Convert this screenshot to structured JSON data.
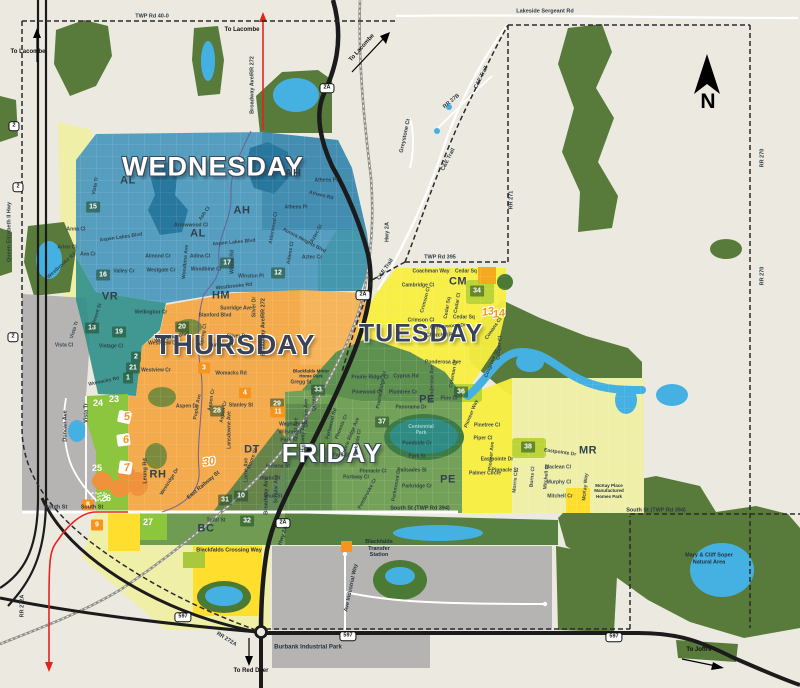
{
  "compass": {
    "label": "N"
  },
  "colors": {
    "background": "#ECEAE0",
    "forest": "#587B3B",
    "water": "#45B1E3",
    "wednesday": "#4A98BC",
    "thursday": "#F4A844",
    "tuesday": "#F8EE3F",
    "friday": "#74A159",
    "accent_orange": "#F7941E",
    "urban_gray": "#B5B4B2",
    "residential_green": "#8CC63F",
    "pale_yellow": "#EFEFA8",
    "route_red": "#E8211D"
  },
  "day_labels": [
    {
      "t": "WEDNESDAY",
      "x": 213,
      "y": 167,
      "v": "light",
      "s": 27
    },
    {
      "t": "THURSDAY",
      "x": 235,
      "y": 345,
      "v": "dark",
      "s": 28
    },
    {
      "t": "TUESDAY",
      "x": 421,
      "y": 334,
      "v": "dark",
      "s": 25
    },
    {
      "t": "FRIDAY",
      "x": 332,
      "y": 453,
      "v": "light",
      "s": 26
    }
  ],
  "area_codes": [
    {
      "t": "AL",
      "x": 128,
      "y": 181
    },
    {
      "t": "AL",
      "x": 198,
      "y": 234
    },
    {
      "t": "AH",
      "x": 293,
      "y": 174
    },
    {
      "t": "AH",
      "x": 242,
      "y": 211
    },
    {
      "t": "VR",
      "x": 110,
      "y": 297
    },
    {
      "t": "HM",
      "x": 221,
      "y": 296
    },
    {
      "t": "RH",
      "x": 158,
      "y": 475
    },
    {
      "t": "DT",
      "x": 252,
      "y": 450
    },
    {
      "t": "CM",
      "x": 458,
      "y": 282
    },
    {
      "t": "PE",
      "x": 427,
      "y": 400
    },
    {
      "t": "PE",
      "x": 448,
      "y": 480
    },
    {
      "t": "MR",
      "x": 588,
      "y": 451
    },
    {
      "t": "BC",
      "x": 206,
      "y": 529
    }
  ],
  "badges": {
    "green": [
      {
        "n": "15",
        "x": 93,
        "y": 207
      },
      {
        "n": "16",
        "x": 103,
        "y": 275
      },
      {
        "n": "17",
        "x": 227,
        "y": 263
      },
      {
        "n": "12",
        "x": 278,
        "y": 273
      },
      {
        "n": "18",
        "x": 92,
        "y": 328
      },
      {
        "n": "19",
        "x": 119,
        "y": 332
      },
      {
        "n": "20",
        "x": 182,
        "y": 327
      },
      {
        "n": "2",
        "x": 136,
        "y": 357
      },
      {
        "n": "21",
        "x": 133,
        "y": 368
      },
      {
        "n": "1",
        "x": 128,
        "y": 378
      },
      {
        "n": "28",
        "x": 217,
        "y": 411
      },
      {
        "n": "29",
        "x": 277,
        "y": 404
      },
      {
        "n": "33",
        "x": 318,
        "y": 390
      },
      {
        "n": "31",
        "x": 225,
        "y": 500
      },
      {
        "n": "10",
        "x": 241,
        "y": 496
      },
      {
        "n": "32",
        "x": 247,
        "y": 521
      },
      {
        "n": "34",
        "x": 477,
        "y": 291
      },
      {
        "n": "36",
        "x": 461,
        "y": 392
      },
      {
        "n": "37",
        "x": 382,
        "y": 422
      },
      {
        "n": "38",
        "x": 528,
        "y": 447
      }
    ],
    "orange": [
      {
        "n": "3",
        "x": 204,
        "y": 368
      },
      {
        "n": "4",
        "x": 245,
        "y": 393
      },
      {
        "n": "11",
        "x": 278,
        "y": 412
      },
      {
        "n": "8",
        "x": 88,
        "y": 505
      },
      {
        "n": "9",
        "x": 97,
        "y": 525
      }
    ],
    "plain": [
      {
        "n": "24",
        "x": 98,
        "y": 403
      },
      {
        "n": "23",
        "x": 114,
        "y": 399
      },
      {
        "n": "25",
        "x": 97,
        "y": 468
      },
      {
        "n": "26",
        "x": 106,
        "y": 498
      },
      {
        "n": "27",
        "x": 148,
        "y": 522
      }
    ],
    "stylized": [
      {
        "n": "5",
        "x": 127,
        "y": 417
      },
      {
        "n": "6",
        "x": 126,
        "y": 440
      },
      {
        "n": "7",
        "x": 127,
        "y": 468
      },
      {
        "n": "13",
        "x": 488,
        "y": 312
      },
      {
        "n": "14",
        "x": 499,
        "y": 314
      },
      {
        "n": "30",
        "x": 209,
        "y": 462
      }
    ]
  },
  "shields": [
    {
      "t": "2",
      "x": 14,
      "y": 126
    },
    {
      "t": "2",
      "x": 18,
      "y": 187
    },
    {
      "t": "2",
      "x": 13,
      "y": 337
    },
    {
      "t": "2A",
      "x": 327,
      "y": 88
    },
    {
      "t": "2A",
      "x": 363,
      "y": 295
    },
    {
      "t": "2A",
      "x": 283,
      "y": 523
    },
    {
      "t": "597",
      "x": 183,
      "y": 617
    },
    {
      "t": "597",
      "x": 348,
      "y": 636
    },
    {
      "t": "597",
      "x": 614,
      "y": 637
    }
  ],
  "road_labels": [
    {
      "t": "TWP Rd 40-0",
      "x": 152,
      "y": 17
    },
    {
      "t": "Lakeside Sergeant Rd",
      "x": 545,
      "y": 12
    },
    {
      "t": "TWP Rd 395",
      "x": 440,
      "y": 258
    },
    {
      "t": "South St",
      "x": 56,
      "y": 508
    },
    {
      "t": "South St",
      "x": 92,
      "y": 508
    },
    {
      "t": "South St (TWP Rd 394)",
      "x": 420,
      "y": 509
    },
    {
      "t": "South St (TWP Rd 394)",
      "x": 656,
      "y": 511
    },
    {
      "t": "RR 270",
      "x": 763,
      "y": 158,
      "r": -90
    },
    {
      "t": "RR 270",
      "x": 763,
      "y": 276,
      "r": -90
    },
    {
      "t": "RR 271",
      "x": 512,
      "y": 200,
      "r": -90
    },
    {
      "t": "C&E Trail",
      "x": 482,
      "y": 78,
      "r": -63
    },
    {
      "t": "C&E Trail",
      "x": 449,
      "y": 160,
      "r": -63
    },
    {
      "t": "C&E Trail",
      "x": 386,
      "y": 270,
      "r": -56
    },
    {
      "t": "RR 27B",
      "x": 452,
      "y": 102,
      "r": -40
    },
    {
      "t": "Greystone Ct",
      "x": 406,
      "y": 136,
      "r": -78
    },
    {
      "t": "Queen Elizabeth II Hwy",
      "x": 10,
      "y": 232,
      "r": -90
    },
    {
      "t": "Broadway Ave/RR 272",
      "x": 253,
      "y": 85,
      "r": -90
    },
    {
      "t": "Broadway Ave/RR 272",
      "x": 264,
      "y": 327,
      "r": -90
    },
    {
      "t": "Broadway Ave",
      "x": 267,
      "y": 496,
      "r": -90
    },
    {
      "t": "Hwy 2A",
      "x": 388,
      "y": 232,
      "r": -90
    },
    {
      "t": "Hwy 2A",
      "x": 284,
      "y": 536,
      "r": -72
    },
    {
      "t": "RR 272A",
      "x": 23,
      "y": 606,
      "r": -90
    },
    {
      "t": "RR 272A",
      "x": 226,
      "y": 640,
      "r": 32
    },
    {
      "t": "Duncan Ave",
      "x": 66,
      "y": 426,
      "r": -90
    },
    {
      "t": "Vista Tr",
      "x": 87,
      "y": 413,
      "r": -90
    },
    {
      "t": "East Railway St",
      "x": 204,
      "y": 486,
      "r": -40
    },
    {
      "t": "Leung Rd",
      "x": 146,
      "y": 471,
      "r": -90
    },
    {
      "t": "Ave Industrial Way",
      "x": 352,
      "y": 588,
      "r": -78
    }
  ],
  "direction_labels": [
    {
      "t": "To Lacombe",
      "x": 28,
      "y": 52
    },
    {
      "t": "To Lacombe",
      "x": 242,
      "y": 30
    },
    {
      "t": "To Lacombe",
      "x": 362,
      "y": 48,
      "r": -48
    },
    {
      "t": "To Red Deer",
      "x": 251,
      "y": 671
    },
    {
      "t": "To Joffre",
      "x": 699,
      "y": 650
    }
  ],
  "place_labels": [
    {
      "t": "Burbank Industrial Park",
      "x": 308,
      "y": 648,
      "s": 6
    },
    {
      "t": "Blackfalds\nTransfer\nStation",
      "x": 379,
      "y": 549,
      "s": 5.5
    },
    {
      "t": "Blackfalds Crossing Way",
      "x": 229,
      "y": 551,
      "s": 5.5
    },
    {
      "t": "Mary & Cliff Soper\nNatural Area",
      "x": 709,
      "y": 559,
      "s": 5.5
    },
    {
      "t": "Centennial\nPark",
      "x": 421,
      "y": 430,
      "s": 5,
      "c": "#9AD3CC"
    },
    {
      "t": "Blackfalds Motor\nHome Park",
      "x": 311,
      "y": 374,
      "s": 4.5
    },
    {
      "t": "McKay Place\nManufactured\nHomes Park",
      "x": 609,
      "y": 491,
      "s": 4.5
    }
  ],
  "street_labels": [
    {
      "t": "Vista Tr",
      "x": 96,
      "y": 186,
      "r": -80
    },
    {
      "t": "Anna Cl",
      "x": 76,
      "y": 230
    },
    {
      "t": "Aspen Lakes Blvd",
      "x": 121,
      "y": 238,
      "r": -8
    },
    {
      "t": "Arlen Cl",
      "x": 67,
      "y": 248
    },
    {
      "t": "Ava Cr",
      "x": 88,
      "y": 255
    },
    {
      "t": "Valley Cr",
      "x": 124,
      "y": 272
    },
    {
      "t": "Westgate Cr",
      "x": 161,
      "y": 271
    },
    {
      "t": "Almond Cr",
      "x": 158,
      "y": 257
    },
    {
      "t": "Adina Cl",
      "x": 200,
      "y": 257
    },
    {
      "t": "Arrowwood Cl",
      "x": 191,
      "y": 226
    },
    {
      "t": "Ash Cl",
      "x": 205,
      "y": 214,
      "r": -55
    },
    {
      "t": "Aspen Lakes Blvd",
      "x": 234,
      "y": 243,
      "r": -5
    },
    {
      "t": "Woodbine Cl",
      "x": 206,
      "y": 270
    },
    {
      "t": "Woodbine Ave",
      "x": 186,
      "y": 262,
      "r": -85
    },
    {
      "t": "Willow Rd",
      "x": 233,
      "y": 262,
      "r": -90
    },
    {
      "t": "Winston Pl",
      "x": 251,
      "y": 277
    },
    {
      "t": "Westbrooke Rd",
      "x": 234,
      "y": 287,
      "r": -6
    },
    {
      "t": "Westbrooke Rd",
      "x": 62,
      "y": 266,
      "r": -42
    },
    {
      "t": "Athens Pl",
      "x": 326,
      "y": 181
    },
    {
      "t": "Athens Rd",
      "x": 321,
      "y": 196,
      "r": 14
    },
    {
      "t": "Athens Pl",
      "x": 296,
      "y": 208
    },
    {
      "t": "Alderwood Cl",
      "x": 274,
      "y": 228,
      "r": -80
    },
    {
      "t": "Aurora Heights Blvd",
      "x": 304,
      "y": 241,
      "r": 28
    },
    {
      "t": "Aztec St",
      "x": 317,
      "y": 234,
      "r": -62
    },
    {
      "t": "Aztec Cr",
      "x": 312,
      "y": 258
    },
    {
      "t": "Adams Cl",
      "x": 291,
      "y": 253,
      "r": -80
    },
    {
      "t": "Valmont St",
      "x": 97,
      "y": 316,
      "r": -72
    },
    {
      "t": "Vista Tr",
      "x": 75,
      "y": 330,
      "r": -72
    },
    {
      "t": "Vista Cl",
      "x": 64,
      "y": 346
    },
    {
      "t": "Vintage Cl",
      "x": 111,
      "y": 347
    },
    {
      "t": "Womacks Rd",
      "x": 104,
      "y": 382,
      "r": -12
    },
    {
      "t": "Wellington Cr",
      "x": 151,
      "y": 313
    },
    {
      "t": "Sunridge Ave",
      "x": 236,
      "y": 309
    },
    {
      "t": "Stanford Blvd",
      "x": 215,
      "y": 316
    },
    {
      "t": "Silver Dr",
      "x": 237,
      "y": 337
    },
    {
      "t": "Silver Dr",
      "x": 255,
      "y": 307,
      "r": -90
    },
    {
      "t": "Sunrise Cl",
      "x": 221,
      "y": 346
    },
    {
      "t": "Womacks Blvd",
      "x": 172,
      "y": 338,
      "r": -12
    },
    {
      "t": "Westview Cr",
      "x": 163,
      "y": 344
    },
    {
      "t": "Westview Cr",
      "x": 156,
      "y": 371
    },
    {
      "t": "Spring Cl",
      "x": 204,
      "y": 335,
      "r": -80
    },
    {
      "t": "Womacks Rd",
      "x": 231,
      "y": 374
    },
    {
      "t": "Gregg St",
      "x": 301,
      "y": 383
    },
    {
      "t": "Aspen Dr",
      "x": 187,
      "y": 407
    },
    {
      "t": "Poplar Ave",
      "x": 198,
      "y": 407,
      "r": -80
    },
    {
      "t": "Aspen Cr",
      "x": 212,
      "y": 400,
      "r": -80
    },
    {
      "t": "Aspen Cr",
      "x": 224,
      "y": 412,
      "r": -80
    },
    {
      "t": "Stanley St",
      "x": 241,
      "y": 406
    },
    {
      "t": "Lansdowne Ave",
      "x": 230,
      "y": 430,
      "r": -90
    },
    {
      "t": "Westridge Dr",
      "x": 170,
      "y": 482,
      "r": -58
    },
    {
      "t": "Coachman Way",
      "x": 431,
      "y": 272
    },
    {
      "t": "Cedar Sq",
      "x": 466,
      "y": 272
    },
    {
      "t": "Cambridge Cl",
      "x": 418,
      "y": 286
    },
    {
      "t": "Crimson Cl",
      "x": 426,
      "y": 300,
      "r": -75
    },
    {
      "t": "Crimson Cl",
      "x": 421,
      "y": 321
    },
    {
      "t": "Cedar Sq",
      "x": 448,
      "y": 308,
      "r": -80
    },
    {
      "t": "Cedar Cl",
      "x": 458,
      "y": 303,
      "r": -80
    },
    {
      "t": "Cedar Sq",
      "x": 464,
      "y": 318
    },
    {
      "t": "Cottonwood Dr",
      "x": 448,
      "y": 327,
      "r": -4
    },
    {
      "t": "Churchill Pl",
      "x": 440,
      "y": 336
    },
    {
      "t": "Cowans Cl",
      "x": 494,
      "y": 329,
      "r": -55
    },
    {
      "t": "Cooper Cl",
      "x": 500,
      "y": 348,
      "r": -85
    },
    {
      "t": "Cosgrove St",
      "x": 492,
      "y": 364,
      "r": -68
    },
    {
      "t": "Ponderosa Ave",
      "x": 443,
      "y": 363
    },
    {
      "t": "Ponderosa Ave",
      "x": 433,
      "y": 383,
      "r": -90
    },
    {
      "t": "Coleman Cr",
      "x": 454,
      "y": 374,
      "r": -80
    },
    {
      "t": "Cyprus Rd",
      "x": 406,
      "y": 377
    },
    {
      "t": "Prairie Ridge Cl",
      "x": 370,
      "y": 378
    },
    {
      "t": "Pinewood Cl",
      "x": 367,
      "y": 393
    },
    {
      "t": "Prairie Ridge Av",
      "x": 382,
      "y": 390,
      "r": -80
    },
    {
      "t": "Plumtree Cr",
      "x": 403,
      "y": 393
    },
    {
      "t": "Pine Cl",
      "x": 449,
      "y": 399
    },
    {
      "t": "Pioneer Way",
      "x": 472,
      "y": 414,
      "r": -68
    },
    {
      "t": "Pinetree Cl",
      "x": 487,
      "y": 426
    },
    {
      "t": "Piper Cl",
      "x": 483,
      "y": 439
    },
    {
      "t": "Pioneer Ave",
      "x": 492,
      "y": 456,
      "r": -85
    },
    {
      "t": "Eastpointe Dr",
      "x": 497,
      "y": 460
    },
    {
      "t": "Eastpointe Dr",
      "x": 560,
      "y": 453,
      "r": 8
    },
    {
      "t": "Palmer Circle",
      "x": 485,
      "y": 474
    },
    {
      "t": "Morris Cl",
      "x": 516,
      "y": 482,
      "r": -85
    },
    {
      "t": "Burns Cl",
      "x": 533,
      "y": 477,
      "r": -85
    },
    {
      "t": "Mitchell Cl",
      "x": 547,
      "y": 477,
      "r": -85
    },
    {
      "t": "Maclean Cl",
      "x": 558,
      "y": 468
    },
    {
      "t": "Murphy Cl",
      "x": 559,
      "y": 483
    },
    {
      "t": "Mitchell Cr",
      "x": 560,
      "y": 497
    },
    {
      "t": "McKay Way",
      "x": 586,
      "y": 487,
      "r": -85
    },
    {
      "t": "Pinnacle St",
      "x": 505,
      "y": 471
    },
    {
      "t": "Panorama Dr",
      "x": 411,
      "y": 408
    },
    {
      "t": "Pondside Cr",
      "x": 417,
      "y": 444
    },
    {
      "t": "Park St",
      "x": 417,
      "y": 457
    },
    {
      "t": "Palisades St",
      "x": 412,
      "y": 471
    },
    {
      "t": "Parkridge Cr",
      "x": 417,
      "y": 487
    },
    {
      "t": "Parkmount Cr",
      "x": 397,
      "y": 485,
      "r": -80
    },
    {
      "t": "Pembrooke Cr",
      "x": 368,
      "y": 494,
      "r": -62
    },
    {
      "t": "Pinnacle Cl",
      "x": 373,
      "y": 472
    },
    {
      "t": "Portway Cl",
      "x": 356,
      "y": 478
    },
    {
      "t": "Parkwood Rd",
      "x": 332,
      "y": 424,
      "r": -75
    },
    {
      "t": "Phoenix Cr",
      "x": 342,
      "y": 427,
      "r": -68
    },
    {
      "t": "Prairie Ridge Ave",
      "x": 351,
      "y": 437,
      "r": -68
    },
    {
      "t": "Parkside Cl",
      "x": 358,
      "y": 443,
      "r": -80
    },
    {
      "t": "Park St",
      "x": 341,
      "y": 456
    },
    {
      "t": "Waghorn St",
      "x": 293,
      "y": 425
    },
    {
      "t": "Wilson St",
      "x": 290,
      "y": 433
    },
    {
      "t": "Park St",
      "x": 289,
      "y": 441
    },
    {
      "t": "East Ave",
      "x": 297,
      "y": 428,
      "r": -90
    },
    {
      "t": "Lambin Ave",
      "x": 307,
      "y": 413,
      "r": -90
    },
    {
      "t": "Queen Cl",
      "x": 315,
      "y": 400,
      "r": -90
    },
    {
      "t": "Highway Ave",
      "x": 304,
      "y": 437,
      "r": -90
    },
    {
      "t": "Moore St",
      "x": 253,
      "y": 459,
      "r": -70
    },
    {
      "t": "Lorne Ave",
      "x": 247,
      "y": 470,
      "r": -90
    },
    {
      "t": "Indiana St",
      "x": 278,
      "y": 467
    },
    {
      "t": "Winks St",
      "x": 270,
      "y": 479
    },
    {
      "t": "Schular Ave",
      "x": 277,
      "y": 489,
      "r": -90
    },
    {
      "t": "Shull St",
      "x": 273,
      "y": 497
    },
    {
      "t": "Trout St",
      "x": 216,
      "y": 521
    }
  ]
}
